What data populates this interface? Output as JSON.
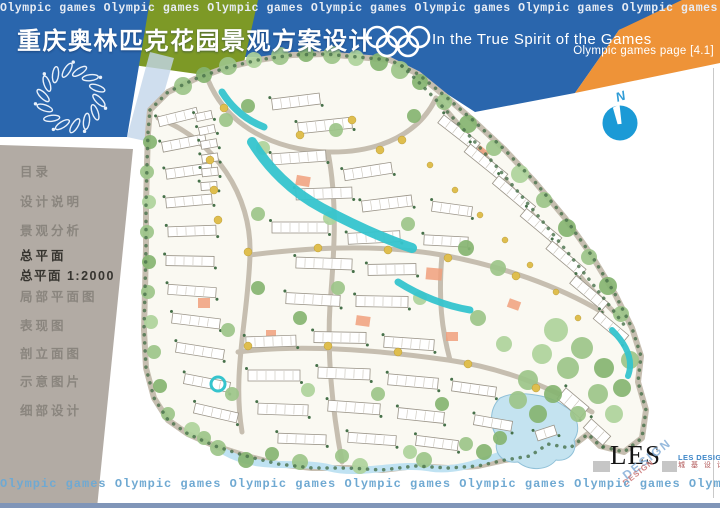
{
  "banner": {
    "ticker_text": "Olympic games Olympic games Olympic games Olympic games  Olympic games  Olympic games  Olympic games  Olympic games  Olympic games",
    "title": "重庆奥林匹克花园景观方案设计",
    "slogan": "In the True Spirit of the Games",
    "page_label": "Olympic games page [4.1]",
    "colors": {
      "blue": "#2a66ad",
      "green": "#7d9926",
      "orange": "#ee9338"
    }
  },
  "sidebar": {
    "items": [
      {
        "label": "目录"
      },
      {
        "label": "设计说明"
      },
      {
        "label": "景观分析"
      },
      {
        "label": "总平面",
        "label2": "总平面  1:2000",
        "active": true
      },
      {
        "label": "局部平面图"
      },
      {
        "label": "表现图"
      },
      {
        "label": "剖立面图"
      },
      {
        "label": "示意图片"
      },
      {
        "label": "细部设计"
      }
    ]
  },
  "compass": {
    "label": "N",
    "color": "#1b9ad6"
  },
  "footer": {
    "ticker_text": "Olympic games Olympic games Olympic games Olympic games  Olympic games  Olympic games  Olympic games"
  },
  "logo": {
    "main": "LES",
    "rotated": "DESIGN",
    "rotated_small": "DESIGN",
    "name_en": "LES DESIGN",
    "name_cn": "城 基 设 计"
  },
  "site_plan": {
    "palette": {
      "base": "#faf9f2",
      "road": "#c6beb0",
      "water": "#35c4cd",
      "pond": "#c4e3f0",
      "pond_edge": "#bfe2f2",
      "accent": "#f0a07c",
      "yellow": "#dfbe4e",
      "dot": "#47714a",
      "trees": [
        "#9cc489",
        "#85b471",
        "#aed39b",
        "#6ba05e"
      ]
    },
    "outline": "M 150,110 L 168,92 195,79 225,68 258,60 292,55 325,54 358,57 390,60 418,74 445,96 475,122 505,150 535,182 565,218 592,256 615,294 632,328 641,356 638,382 646,410 642,438 624,452 600,446 588,434 570,448 548,444 530,456 505,460 478,466 448,468 415,466 382,470 348,468 312,468 278,464 246,456 215,446 188,434 168,420 154,398 146,368 144,330 145,290 146,248 146,205 147,165 148,133 Z",
    "ne_dotted": "M 402,66 C 470,130 560,240 628,330",
    "roads": [
      "M 158,118 C 215,140 252,195 250,255 C 248,318 232,372 242,432",
      "M 208,80 C 228,128 276,150 328,152 C 382,153 420,132 436,98",
      "M 250,255 C 312,247 380,244 442,255 C 502,266 558,286 602,312",
      "M 238,352 C 300,344 378,350 448,360 C 508,369 556,390 592,412",
      "M 328,152 C 338,205 334,255 330,305 C 327,355 332,408 342,462",
      "M 442,255 C 438,300 442,330 450,360",
      "M 436,98 C 472,140 520,196 556,246 C 578,277 598,296 620,318"
    ],
    "streams": [
      [
        "M 222,92 C 232,108 246,120 264,127",
        7
      ],
      [
        "M 252,142 C 268,168 292,192 322,208 C 350,223 382,238 412,248",
        10
      ],
      [
        "M 398,282 C 420,296 446,306 470,310",
        7
      ],
      [
        "M 612,330 C 626,344 634,360 628,376",
        6
      ]
    ],
    "bottom_water": "M 225,452 C 260,472 300,460 330,468 C 360,476 400,462 430,468 C 455,472 480,462 500,455",
    "pond": "M 500,398 C 488,410 490,428 498,438 C 492,452 502,464 518,462 C 530,472 548,470 556,460 C 568,462 578,452 574,440 C 582,428 576,412 564,406 C 548,394 516,390 500,398 Z",
    "fountain": [
      218,
      384,
      7
    ],
    "buildings": [
      [
        158,
        112,
        40,
        10,
        -14
      ],
      [
        162,
        138,
        44,
        10,
        -11
      ],
      [
        166,
        166,
        46,
        10,
        -8
      ],
      [
        166,
        196,
        46,
        10,
        -5
      ],
      [
        168,
        226,
        48,
        10,
        -2
      ],
      [
        166,
        256,
        48,
        10,
        1
      ],
      [
        168,
        286,
        48,
        10,
        4
      ],
      [
        172,
        316,
        48,
        10,
        7
      ],
      [
        176,
        346,
        48,
        10,
        9
      ],
      [
        184,
        378,
        46,
        10,
        11
      ],
      [
        194,
        408,
        44,
        10,
        13
      ],
      [
        196,
        112,
        16,
        8,
        -12
      ],
      [
        199,
        126,
        16,
        8,
        -12
      ],
      [
        201,
        140,
        16,
        8,
        -10
      ],
      [
        202,
        154,
        16,
        8,
        -8
      ],
      [
        202,
        168,
        16,
        8,
        -6
      ],
      [
        201,
        182,
        16,
        8,
        -4
      ],
      [
        272,
        96,
        48,
        11,
        -7
      ],
      [
        298,
        120,
        54,
        11,
        -6
      ],
      [
        272,
        152,
        54,
        11,
        -4
      ],
      [
        344,
        166,
        48,
        11,
        -9
      ],
      [
        296,
        188,
        56,
        11,
        -2
      ],
      [
        362,
        198,
        50,
        11,
        -7
      ],
      [
        272,
        222,
        56,
        11,
        0
      ],
      [
        348,
        232,
        52,
        11,
        -3
      ],
      [
        296,
        258,
        56,
        11,
        2
      ],
      [
        368,
        264,
        48,
        11,
        -1
      ],
      [
        286,
        294,
        54,
        11,
        3
      ],
      [
        356,
        296,
        52,
        11,
        1
      ],
      [
        424,
        236,
        44,
        10,
        3
      ],
      [
        432,
        204,
        40,
        10,
        8
      ],
      [
        436,
        128,
        46,
        10,
        38
      ],
      [
        462,
        158,
        48,
        10,
        39
      ],
      [
        490,
        190,
        48,
        10,
        40
      ],
      [
        518,
        222,
        46,
        10,
        40
      ],
      [
        544,
        254,
        44,
        10,
        40
      ],
      [
        568,
        288,
        42,
        10,
        40
      ],
      [
        592,
        322,
        38,
        10,
        40
      ],
      [
        246,
        336,
        50,
        11,
        -2
      ],
      [
        314,
        332,
        52,
        11,
        1
      ],
      [
        384,
        338,
        50,
        11,
        4
      ],
      [
        248,
        370,
        52,
        11,
        0
      ],
      [
        318,
        368,
        52,
        11,
        2
      ],
      [
        388,
        376,
        50,
        11,
        5
      ],
      [
        452,
        384,
        44,
        10,
        8
      ],
      [
        258,
        404,
        50,
        11,
        2
      ],
      [
        328,
        402,
        52,
        11,
        4
      ],
      [
        398,
        410,
        46,
        11,
        6
      ],
      [
        278,
        434,
        48,
        10,
        2
      ],
      [
        348,
        434,
        48,
        10,
        4
      ],
      [
        416,
        438,
        42,
        10,
        7
      ],
      [
        474,
        418,
        38,
        10,
        10
      ],
      [
        558,
        396,
        30,
        14,
        40
      ],
      [
        584,
        426,
        26,
        12,
        42
      ],
      [
        536,
        428,
        20,
        10,
        -18
      ]
    ],
    "trees": [
      [
        183,
        86,
        9,
        0
      ],
      [
        204,
        75,
        8,
        1
      ],
      [
        228,
        66,
        9,
        0
      ],
      [
        254,
        60,
        8,
        2
      ],
      [
        280,
        56,
        9,
        0
      ],
      [
        306,
        54,
        8,
        1
      ],
      [
        332,
        55,
        9,
        0
      ],
      [
        356,
        58,
        8,
        2
      ],
      [
        379,
        62,
        9,
        1
      ],
      [
        400,
        70,
        9,
        0
      ],
      [
        420,
        82,
        8,
        1
      ],
      [
        444,
        102,
        8,
        0
      ],
      [
        468,
        124,
        9,
        1
      ],
      [
        494,
        148,
        8,
        0
      ],
      [
        520,
        174,
        9,
        2
      ],
      [
        544,
        200,
        8,
        0
      ],
      [
        567,
        228,
        9,
        1
      ],
      [
        589,
        257,
        8,
        0
      ],
      [
        608,
        286,
        9,
        1
      ],
      [
        621,
        314,
        8,
        0
      ],
      [
        556,
        330,
        12,
        2
      ],
      [
        582,
        348,
        11,
        0
      ],
      [
        604,
        368,
        10,
        1
      ],
      [
        568,
        368,
        11,
        0
      ],
      [
        542,
        354,
        10,
        2
      ],
      [
        528,
        380,
        10,
        0
      ],
      [
        553,
        394,
        9,
        1
      ],
      [
        598,
        394,
        10,
        0
      ],
      [
        614,
        414,
        9,
        2
      ],
      [
        578,
        414,
        8,
        0
      ],
      [
        538,
        414,
        9,
        1
      ],
      [
        518,
        400,
        9,
        0
      ],
      [
        622,
        388,
        9,
        1
      ],
      [
        630,
        360,
        9,
        0
      ],
      [
        150,
        142,
        7,
        1
      ],
      [
        147,
        172,
        7,
        0
      ],
      [
        149,
        202,
        7,
        2
      ],
      [
        147,
        232,
        7,
        0
      ],
      [
        149,
        262,
        7,
        1
      ],
      [
        148,
        292,
        7,
        0
      ],
      [
        151,
        322,
        7,
        2
      ],
      [
        154,
        352,
        7,
        0
      ],
      [
        160,
        386,
        7,
        1
      ],
      [
        168,
        414,
        7,
        0
      ],
      [
        263,
        148,
        7,
        2
      ],
      [
        336,
        130,
        7,
        0
      ],
      [
        414,
        116,
        7,
        1
      ],
      [
        258,
        214,
        7,
        0
      ],
      [
        330,
        218,
        7,
        2
      ],
      [
        408,
        224,
        7,
        0
      ],
      [
        466,
        248,
        8,
        1
      ],
      [
        498,
        268,
        8,
        0
      ],
      [
        258,
        288,
        7,
        1
      ],
      [
        338,
        288,
        7,
        0
      ],
      [
        420,
        298,
        7,
        2
      ],
      [
        478,
        318,
        8,
        0
      ],
      [
        228,
        330,
        7,
        0
      ],
      [
        300,
        318,
        7,
        1
      ],
      [
        504,
        344,
        8,
        2
      ],
      [
        232,
        394,
        7,
        0
      ],
      [
        308,
        390,
        7,
        2
      ],
      [
        378,
        394,
        7,
        0
      ],
      [
        442,
        404,
        7,
        1
      ],
      [
        204,
        438,
        7,
        0
      ],
      [
        272,
        454,
        7,
        1
      ],
      [
        342,
        456,
        7,
        0
      ],
      [
        410,
        452,
        7,
        2
      ],
      [
        466,
        444,
        7,
        0
      ],
      [
        500,
        438,
        7,
        1
      ],
      [
        226,
        120,
        7,
        0
      ],
      [
        248,
        106,
        7,
        1
      ],
      [
        192,
        430,
        8,
        2
      ],
      [
        218,
        448,
        8,
        0
      ],
      [
        246,
        460,
        8,
        1
      ],
      [
        300,
        462,
        8,
        0
      ],
      [
        360,
        466,
        8,
        2
      ],
      [
        424,
        460,
        8,
        0
      ],
      [
        484,
        452,
        8,
        1
      ]
    ],
    "yellow_dots": [
      [
        224,
        108,
        4
      ],
      [
        248,
        252,
        4
      ],
      [
        318,
        248,
        4
      ],
      [
        388,
        250,
        4
      ],
      [
        448,
        258,
        4
      ],
      [
        516,
        276,
        4
      ],
      [
        248,
        346,
        4
      ],
      [
        328,
        346,
        4
      ],
      [
        398,
        352,
        4
      ],
      [
        468,
        364,
        4
      ],
      [
        536,
        388,
        4
      ],
      [
        210,
        160,
        4
      ],
      [
        214,
        190,
        4
      ],
      [
        218,
        220,
        4
      ],
      [
        380,
        150,
        4
      ],
      [
        402,
        140,
        4
      ],
      [
        352,
        120,
        4
      ],
      [
        300,
        135,
        4
      ],
      [
        430,
        165,
        3
      ],
      [
        455,
        190,
        3
      ],
      [
        480,
        215,
        3
      ],
      [
        505,
        240,
        3
      ],
      [
        530,
        265,
        3
      ],
      [
        556,
        292,
        3
      ],
      [
        578,
        318,
        3
      ]
    ],
    "accents": [
      [
        296,
        176,
        14,
        10,
        10
      ],
      [
        426,
        268,
        16,
        12,
        5
      ],
      [
        198,
        298,
        12,
        10,
        0
      ],
      [
        356,
        316,
        14,
        10,
        8
      ],
      [
        476,
        148,
        12,
        9,
        40
      ],
      [
        446,
        332,
        12,
        9,
        0
      ],
      [
        266,
        330,
        10,
        8,
        0
      ],
      [
        508,
        300,
        12,
        9,
        20
      ]
    ]
  }
}
